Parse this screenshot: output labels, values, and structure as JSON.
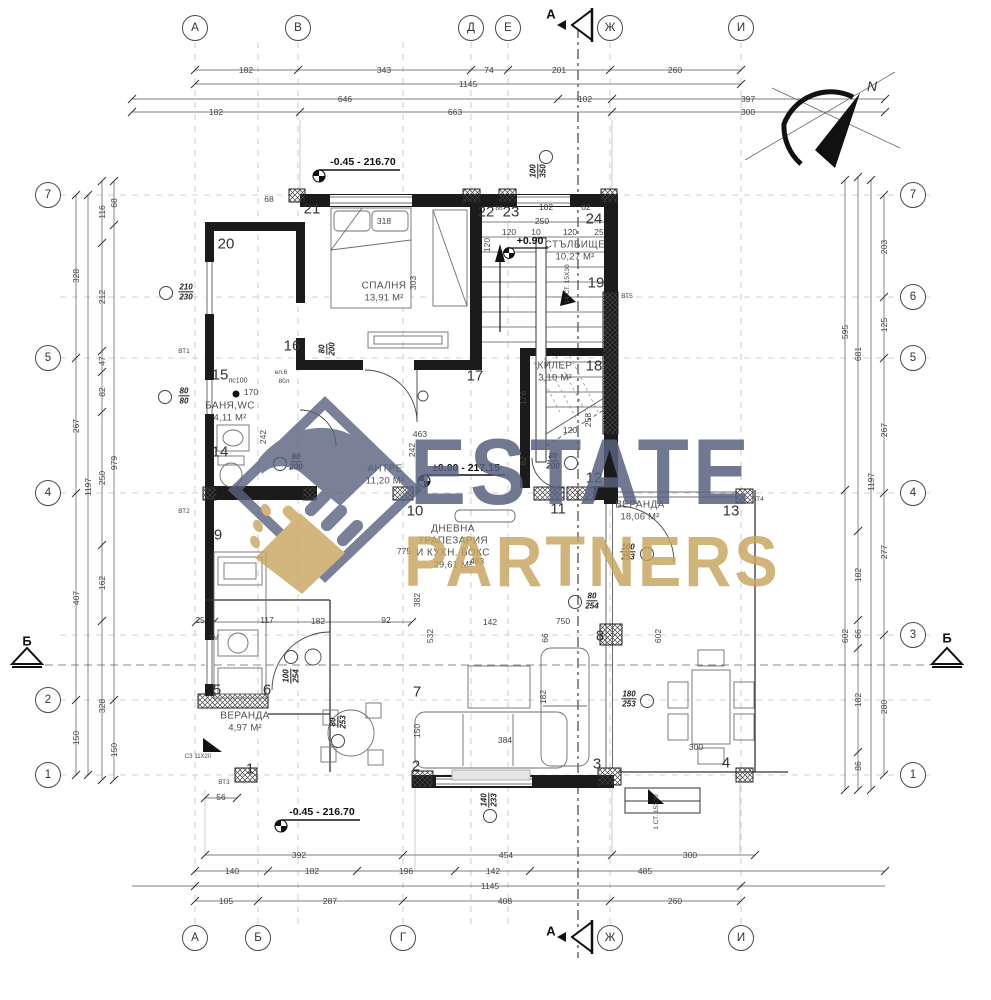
{
  "watermark": {
    "line1": "ESTATE",
    "line2": "PARTNERS",
    "color_primary": "#59617f",
    "color_secondary": "#c8a45e"
  },
  "north": {
    "label": "N"
  },
  "axes": {
    "topY": 28,
    "bottomY": 938,
    "leftX": 48,
    "rightX": 913,
    "top": [
      {
        "id": "А",
        "x": 195
      },
      {
        "id": "В",
        "x": 298
      },
      {
        "id": "Д",
        "x": 471
      },
      {
        "id": "Е",
        "x": 508
      },
      {
        "id": "Ж",
        "x": 610
      },
      {
        "id": "И",
        "x": 741
      }
    ],
    "bottom": [
      {
        "id": "А",
        "x": 195
      },
      {
        "id": "Б",
        "x": 258
      },
      {
        "id": "Г",
        "x": 403
      },
      {
        "id": "Ж",
        "x": 610
      },
      {
        "id": "И",
        "x": 741
      }
    ],
    "left": [
      {
        "id": "7",
        "y": 195
      },
      {
        "id": "5",
        "y": 358
      },
      {
        "id": "4",
        "y": 493
      },
      {
        "id": "2",
        "y": 700
      },
      {
        "id": "1",
        "y": 775
      }
    ],
    "right": [
      {
        "id": "7",
        "y": 195
      },
      {
        "id": "6",
        "y": 297
      },
      {
        "id": "5",
        "y": 358
      },
      {
        "id": "4",
        "y": 493
      },
      {
        "id": "3",
        "y": 635
      },
      {
        "id": "1",
        "y": 775
      }
    ]
  },
  "sections": [
    {
      "label": "А",
      "x": 551,
      "y": 14
    },
    {
      "label": "А",
      "x": 551,
      "y": 931
    },
    {
      "label": "Б",
      "x": 27,
      "y": 641
    },
    {
      "label": "Б",
      "x": 947,
      "y": 638
    }
  ],
  "dims": {
    "top": [
      {
        "y": 70,
        "labels": [
          {
            "t": "182",
            "x": 246
          },
          {
            "t": "343",
            "x": 384
          },
          {
            "t": "74",
            "x": 489
          },
          {
            "t": "201",
            "x": 559
          },
          {
            "t": "260",
            "x": 675
          }
        ]
      },
      {
        "y": 84,
        "labels": [
          {
            "t": "1145",
            "x": 468
          }
        ]
      },
      {
        "y": 99,
        "labels": [
          {
            "t": "646",
            "x": 345
          },
          {
            "t": "102",
            "x": 585
          },
          {
            "t": "397",
            "x": 748
          }
        ]
      },
      {
        "y": 112,
        "labels": [
          {
            "t": "182",
            "x": 216
          },
          {
            "t": "663",
            "x": 455
          },
          {
            "t": "300",
            "x": 748
          }
        ]
      }
    ],
    "bottom": [
      {
        "y": 855,
        "labels": [
          {
            "t": "392",
            "x": 299
          },
          {
            "t": "454",
            "x": 506
          },
          {
            "t": "300",
            "x": 690
          }
        ]
      },
      {
        "y": 871,
        "labels": [
          {
            "t": "140",
            "x": 232
          },
          {
            "t": "182",
            "x": 312
          },
          {
            "t": "196",
            "x": 406
          },
          {
            "t": "142",
            "x": 493
          },
          {
            "t": "485",
            "x": 645
          }
        ]
      },
      {
        "y": 886,
        "labels": [
          {
            "t": "1145",
            "x": 490
          }
        ]
      },
      {
        "y": 901,
        "labels": [
          {
            "t": "105",
            "x": 226
          },
          {
            "t": "287",
            "x": 330
          },
          {
            "t": "408",
            "x": 505
          },
          {
            "t": "260",
            "x": 675
          }
        ]
      }
    ],
    "left": [
      {
        "x": 76,
        "labels": [
          {
            "t": "328",
            "y": 276
          },
          {
            "t": "267",
            "y": 426
          },
          {
            "t": "407",
            "y": 598
          },
          {
            "t": "150",
            "y": 738
          }
        ]
      },
      {
        "x": 88,
        "labels": [
          {
            "t": "1197",
            "y": 487
          }
        ]
      },
      {
        "x": 102,
        "labels": [
          {
            "t": "116",
            "y": 212
          },
          {
            "t": "212",
            "y": 297
          },
          {
            "t": "47",
            "y": 361
          },
          {
            "t": "82",
            "y": 392
          },
          {
            "t": "250",
            "y": 478
          },
          {
            "t": "162",
            "y": 583
          },
          {
            "t": "328",
            "y": 706
          }
        ]
      },
      {
        "x": 114,
        "labels": [
          {
            "t": "68",
            "y": 203
          },
          {
            "t": "979",
            "y": 463
          },
          {
            "t": "150",
            "y": 750
          }
        ]
      }
    ],
    "right": [
      {
        "x": 845,
        "labels": [
          {
            "t": "595",
            "y": 332
          },
          {
            "t": "602",
            "y": 636
          }
        ]
      },
      {
        "x": 858,
        "labels": [
          {
            "t": "681",
            "y": 354
          },
          {
            "t": "182",
            "y": 575
          },
          {
            "t": "66",
            "y": 634
          },
          {
            "t": "182",
            "y": 700
          },
          {
            "t": "86",
            "y": 766
          }
        ]
      },
      {
        "x": 871,
        "labels": [
          {
            "t": "1197",
            "y": 482
          }
        ]
      },
      {
        "x": 884,
        "labels": [
          {
            "t": "203",
            "y": 247
          },
          {
            "t": "125",
            "y": 325
          },
          {
            "t": "267",
            "y": 430
          },
          {
            "t": "277",
            "y": 552
          },
          {
            "t": "280",
            "y": 707
          }
        ]
      }
    ]
  },
  "rooms": [
    {
      "lines": [
        "СПАЛНЯ"
      ],
      "area": "13,91 М²",
      "x": 384,
      "y": 292
    },
    {
      "lines": [
        "СТЪЛБИЩЕ"
      ],
      "area": "10,27 М²",
      "x": 575,
      "y": 251
    },
    {
      "lines": [
        "КИЛЕР"
      ],
      "area": "3,10 М²",
      "x": 555,
      "y": 372
    },
    {
      "lines": [
        "БАНЯ,WC"
      ],
      "area": "4,11 М²",
      "x": 230,
      "y": 412
    },
    {
      "lines": [
        "АНТРЕ"
      ],
      "area": "11,20 М²",
      "x": 385,
      "y": 475
    },
    {
      "lines": [
        "ДНЕВНА",
        "ТРАПЕЗАРИЯ",
        "И КУХН. БОКС"
      ],
      "area": "29,61 М²",
      "x": 453,
      "y": 547
    },
    {
      "lines": [
        "ВЕРАНДА"
      ],
      "area": "4,97 М²",
      "x": 245,
      "y": 722
    },
    {
      "lines": [
        "ВЕРАНДА"
      ],
      "area": "18,06 М²",
      "x": 640,
      "y": 511
    }
  ],
  "elevations": [
    {
      "t": "-0.45 - 216.70",
      "x": 363,
      "y": 162
    },
    {
      "t": "±0.00 - 217.15",
      "x": 466,
      "y": 468
    },
    {
      "t": "-0.45 - 216.70",
      "x": 322,
      "y": 812
    },
    {
      "t": "+0.90",
      "x": 530,
      "y": 241
    }
  ],
  "tags": [
    {
      "t": "20",
      "x": 226,
      "y": 244
    },
    {
      "t": "21",
      "x": 312,
      "y": 209
    },
    {
      "t": "22",
      "x": 486,
      "y": 212
    },
    {
      "t": "23",
      "x": 511,
      "y": 212
    },
    {
      "t": "24",
      "x": 594,
      "y": 219
    },
    {
      "t": "19",
      "x": 596,
      "y": 283
    },
    {
      "t": "18",
      "x": 594,
      "y": 366
    },
    {
      "t": "17",
      "x": 475,
      "y": 376
    },
    {
      "t": "16",
      "x": 292,
      "y": 346
    },
    {
      "t": "15",
      "x": 220,
      "y": 375
    },
    {
      "t": "14",
      "x": 220,
      "y": 452
    },
    {
      "t": "13",
      "x": 731,
      "y": 511
    },
    {
      "t": "12",
      "x": 594,
      "y": 478
    },
    {
      "t": "11",
      "x": 558,
      "y": 509
    },
    {
      "t": "10",
      "x": 415,
      "y": 511
    },
    {
      "t": "9",
      "x": 218,
      "y": 535
    },
    {
      "t": "8",
      "x": 600,
      "y": 636
    },
    {
      "t": "7",
      "x": 417,
      "y": 692
    },
    {
      "t": "6",
      "x": 267,
      "y": 690
    },
    {
      "t": "5",
      "x": 217,
      "y": 690
    },
    {
      "t": "4",
      "x": 726,
      "y": 763
    },
    {
      "t": "3",
      "x": 597,
      "y": 764
    },
    {
      "t": "2",
      "x": 416,
      "y": 766
    },
    {
      "t": "1",
      "x": 250,
      "y": 769
    }
  ],
  "markers": [
    {
      "top": "210",
      "bottom": "230",
      "x": 186,
      "y": 292,
      "cx": 166,
      "cy": 293
    },
    {
      "top": "80",
      "bottom": "80",
      "x": 184,
      "y": 396,
      "cx": 165,
      "cy": 397
    },
    {
      "top": "80",
      "bottom": "200",
      "x": 296,
      "y": 462,
      "cx": 280,
      "cy": 464
    },
    {
      "top": "80",
      "bottom": "200",
      "x": 553,
      "y": 461,
      "cx": 571,
      "cy": 463
    },
    {
      "top": "100",
      "bottom": "254",
      "x": 291,
      "y": 676,
      "cx": 291,
      "cy": 657,
      "rot": 1
    },
    {
      "top": "80",
      "bottom": "253",
      "x": 338,
      "y": 722,
      "cx": 338,
      "cy": 741,
      "rot": 1
    },
    {
      "top": "180",
      "bottom": "253",
      "x": 629,
      "y": 699,
      "cx": 647,
      "cy": 701
    },
    {
      "top": "140",
      "bottom": "233",
      "x": 489,
      "y": 800,
      "c x": 0,
      "cx": 490,
      "cy": 816,
      "rot": 1
    },
    {
      "top": "100",
      "bottom": "350",
      "x": 538,
      "y": 171,
      "cx": 546,
      "cy": 157,
      "rot": 1
    },
    {
      "top": "100",
      "bottom": "253",
      "x": 628,
      "y": 552,
      "cx": 647,
      "cy": 554
    },
    {
      "top": "80",
      "bottom": "254",
      "x": 592,
      "y": 601,
      "cx": 575,
      "cy": 602
    },
    {
      "top": "80",
      "bottom": "200",
      "x": 327,
      "y": 349,
      "rot": 1
    }
  ],
  "notes": [
    {
      "t": "68",
      "x": 269,
      "y": 199
    },
    {
      "t": "318",
      "x": 384,
      "y": 221
    },
    {
      "t": "303",
      "x": 413,
      "y": 283,
      "rot": 1
    },
    {
      "t": "120",
      "x": 487,
      "y": 245,
      "rot": 1
    },
    {
      "t": "102",
      "x": 546,
      "y": 207
    },
    {
      "t": "62",
      "x": 586,
      "y": 207
    },
    {
      "t": "250",
      "x": 542,
      "y": 221
    },
    {
      "t": "120",
      "x": 509,
      "y": 232
    },
    {
      "t": "10",
      "x": 536,
      "y": 232
    },
    {
      "t": "120",
      "x": 570,
      "y": 232
    },
    {
      "t": "25",
      "x": 599,
      "y": 232
    },
    {
      "t": "86",
      "x": 499,
      "y": 209,
      "fs": 6.5
    },
    {
      "t": "170",
      "x": 251,
      "y": 392
    },
    {
      "t": "242",
      "x": 263,
      "y": 437,
      "rot": 1
    },
    {
      "t": "176",
      "x": 523,
      "y": 398,
      "rot": 1
    },
    {
      "t": "258",
      "x": 588,
      "y": 420,
      "rot": 1
    },
    {
      "t": "120",
      "x": 570,
      "y": 430
    },
    {
      "t": "82",
      "x": 523,
      "y": 461,
      "rot": 1
    },
    {
      "t": "463",
      "x": 420,
      "y": 434
    },
    {
      "t": "242",
      "x": 412,
      "y": 450,
      "rot": 1
    },
    {
      "t": "483",
      "x": 477,
      "y": 561
    },
    {
      "t": "775",
      "x": 404,
      "y": 551
    },
    {
      "t": "382",
      "x": 417,
      "y": 600,
      "rot": 1
    },
    {
      "t": "532",
      "x": 430,
      "y": 636,
      "rot": 1
    },
    {
      "t": "25",
      "x": 200,
      "y": 620
    },
    {
      "t": "117",
      "x": 267,
      "y": 620
    },
    {
      "t": "182",
      "x": 318,
      "y": 621
    },
    {
      "t": "92",
      "x": 386,
      "y": 620
    },
    {
      "t": "142",
      "x": 490,
      "y": 622
    },
    {
      "t": "750",
      "x": 563,
      "y": 621
    },
    {
      "t": "66",
      "x": 545,
      "y": 638,
      "rot": 1
    },
    {
      "t": "602",
      "x": 658,
      "y": 636,
      "rot": 1
    },
    {
      "t": "182",
      "x": 543,
      "y": 697,
      "rot": 1
    },
    {
      "t": "150",
      "x": 417,
      "y": 731,
      "rot": 1
    },
    {
      "t": "384",
      "x": 505,
      "y": 740
    },
    {
      "t": "300",
      "x": 696,
      "y": 747
    },
    {
      "t": "56",
      "x": 221,
      "y": 797
    },
    {
      "t": "14 СТ. 15Х30",
      "x": 568,
      "y": 284,
      "rot": 1,
      "fs": 6.5
    },
    {
      "t": "1 СТ. 15Х30",
      "x": 657,
      "y": 812,
      "rot": 1,
      "fs": 6.5
    },
    {
      "t": "СЗ 11Х20",
      "x": 198,
      "y": 757,
      "fs": 6
    },
    {
      "t": "пс100",
      "x": 238,
      "y": 381,
      "fs": 7
    },
    {
      "t": "ел.6",
      "x": 281,
      "y": 373,
      "fs": 6.5
    },
    {
      "t": "80л",
      "x": 284,
      "y": 382,
      "fs": 6.5
    },
    {
      "t": "ТМ",
      "x": 214,
      "y": 639,
      "fs": 6.5
    },
    {
      "t": "ВТ1",
      "x": 184,
      "y": 352,
      "fs": 6.5
    },
    {
      "t": "ВТ2",
      "x": 184,
      "y": 512,
      "fs": 6.5
    },
    {
      "t": "ВТ3",
      "x": 224,
      "y": 783,
      "fs": 6.5
    },
    {
      "t": "ВТ4",
      "x": 758,
      "y": 500,
      "fs": 6.5
    },
    {
      "t": "ВТ5",
      "x": 627,
      "y": 297,
      "fs": 6.5
    }
  ]
}
